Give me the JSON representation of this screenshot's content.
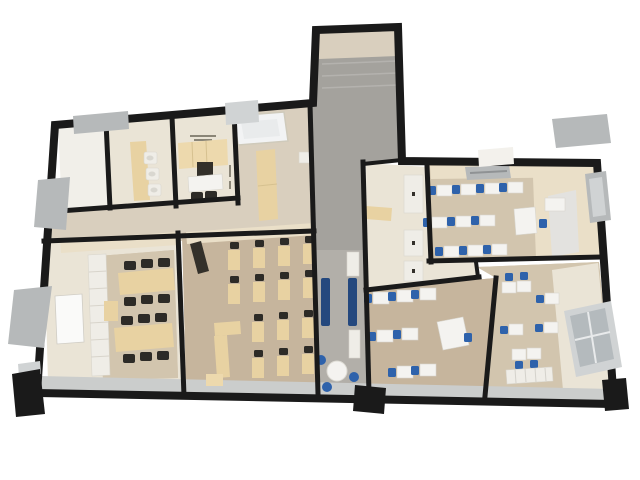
{
  "meta": {
    "title": "3D top-down cutaway rendering of an office / school floor plan",
    "background": "#ffffff",
    "legible_text_on_image": "none (only tiny illegible print on kitchenette floor and lobby wall)"
  },
  "colors": {
    "wall": "#1a1a1a",
    "floor_white": "#f1efe9",
    "floor_cream": "#eae4d6",
    "floor_beige": "#d9cfbe",
    "floor_wood": "#c6b59d",
    "floor_wood_light": "#d2c5ae",
    "floor_gray": "#a4a29d",
    "floor_gray_light": "#b2afa9",
    "floor_tile": "#cbcdcc",
    "wall_face_cream": "#eadfc8",
    "wall_face_white": "#f3f1ec",
    "desk_tan": "#e8d2a2",
    "desk_tan_light": "#edd9ad",
    "desk_white": "#f4f3f0",
    "chair_black": "#2d2b27",
    "chair_blue": "#2e62ab",
    "bench_blue": "#24487e",
    "appliance_dark": "#33302a",
    "slab_gray": "#b6b9ba",
    "slab_gray_light": "#d0d3d4",
    "glass_gray": "#b4babd",
    "shelf_white": "#efede7",
    "board_white": "#fafaf9",
    "text_gray": "#8a8577"
  },
  "rooms": [
    {
      "id": "room-1",
      "name": "small empty room (top-left)",
      "floor": "floor_white",
      "furniture": []
    },
    {
      "id": "room-2",
      "name": "washroom with sink counter",
      "floor": "floor_cream",
      "furniture": [
        {
          "item": "counter",
          "count": 1,
          "color": "desk_tan"
        },
        {
          "item": "sink",
          "count": 3,
          "color": "shelf_white"
        }
      ]
    },
    {
      "id": "room-3",
      "name": "kitchenette",
      "floor": "floor_cream",
      "furniture": [
        {
          "item": "cabinet-row",
          "count": 1,
          "color": "desk_tan_light"
        },
        {
          "item": "appliance",
          "count": 1,
          "color": "appliance_dark"
        },
        {
          "item": "table",
          "count": 1,
          "color": "desk_white"
        },
        {
          "item": "chair",
          "count": 2,
          "color": "chair_black"
        }
      ]
    },
    {
      "id": "lobby",
      "name": "entry lobby corridor",
      "floor": "floor_beige",
      "furniture": [
        {
          "item": "skylight-panel",
          "count": 1,
          "color": "board_white"
        },
        {
          "item": "tall-cabinet",
          "count": 1,
          "color": "desk_tan"
        },
        {
          "item": "ac-unit",
          "count": 1,
          "color": "shelf_white"
        }
      ]
    },
    {
      "id": "stair-shaft",
      "name": "stair shaft and central corridor",
      "floor": "floor_gray",
      "furniture": [
        {
          "item": "bench",
          "count": 2,
          "color": "bench_blue"
        },
        {
          "item": "round-table",
          "count": 1,
          "color": "desk_white"
        },
        {
          "item": "stool",
          "count": 3,
          "color": "chair_blue"
        },
        {
          "item": "wall-cabinet",
          "count": 2,
          "color": "shelf_white"
        }
      ]
    },
    {
      "id": "room-5",
      "name": "seminar room (left)",
      "floor": "floor_cream",
      "furniture": [
        {
          "item": "long-table",
          "count": 2,
          "color": "desk_tan"
        },
        {
          "item": "chair",
          "count": 12,
          "color": "chair_black"
        },
        {
          "item": "whiteboard",
          "count": 1,
          "color": "board_white"
        },
        {
          "item": "shelf-column",
          "count": 1,
          "color": "shelf_white"
        },
        {
          "item": "side-table",
          "count": 1,
          "color": "desk_tan"
        }
      ]
    },
    {
      "id": "room-6",
      "name": "classroom (center-left)",
      "floor": "floor_wood",
      "furniture": [
        {
          "item": "student-desk",
          "count": 14,
          "color": "desk_tan"
        },
        {
          "item": "chair",
          "count": 14,
          "color": "chair_black"
        },
        {
          "item": "teacher-desk-L",
          "count": 1,
          "color": "desk_tan"
        },
        {
          "item": "wall-tv",
          "count": 1,
          "color": "appliance_dark"
        }
      ]
    },
    {
      "id": "room-7",
      "name": "narrow WC / storage room",
      "floor": "floor_cream",
      "furniture": [
        {
          "item": "counter",
          "count": 1,
          "color": "desk_tan"
        },
        {
          "item": "stall-panel",
          "count": 3,
          "color": "shelf_white"
        }
      ]
    },
    {
      "id": "room-8",
      "name": "classroom (top-right)",
      "floor": "floor_wood_light",
      "furniture": [
        {
          "item": "student-desk",
          "count": 10,
          "color": "desk_white"
        },
        {
          "item": "chair",
          "count": 11,
          "color": "chair_blue"
        },
        {
          "item": "teacher-desk",
          "count": 1,
          "color": "desk_white"
        },
        {
          "item": "sideboard",
          "count": 1,
          "color": "desk_white"
        },
        {
          "item": "ceiling-vent",
          "count": 1,
          "color": "slab_gray"
        },
        {
          "item": "window-slab",
          "count": 1,
          "color": "slab_gray"
        }
      ]
    },
    {
      "id": "room-9",
      "name": "classroom (bottom-center)",
      "floor": "floor_wood",
      "furniture": [
        {
          "item": "student-desk",
          "count": 7,
          "color": "desk_white"
        },
        {
          "item": "chair",
          "count": 8,
          "color": "chair_blue"
        },
        {
          "item": "teacher-desk",
          "count": 1,
          "color": "desk_white"
        }
      ]
    },
    {
      "id": "room-10",
      "name": "classroom (bottom-right)",
      "floor": "floor_wood_light",
      "furniture": [
        {
          "item": "student-desk",
          "count": 7,
          "color": "desk_white"
        },
        {
          "item": "chair",
          "count": 7,
          "color": "chair_blue"
        },
        {
          "item": "radiator",
          "count": 1,
          "color": "shelf_white"
        },
        {
          "item": "window-glass-pane",
          "count": 1,
          "color": "glass_gray"
        }
      ]
    }
  ],
  "exterior": {
    "window_slabs_gray": 5,
    "roof_pieces_white": 2,
    "entrance_pillar": "bottom-center",
    "corner_pillar": "bottom-right",
    "dark_corner_wedge": "bottom-left"
  }
}
